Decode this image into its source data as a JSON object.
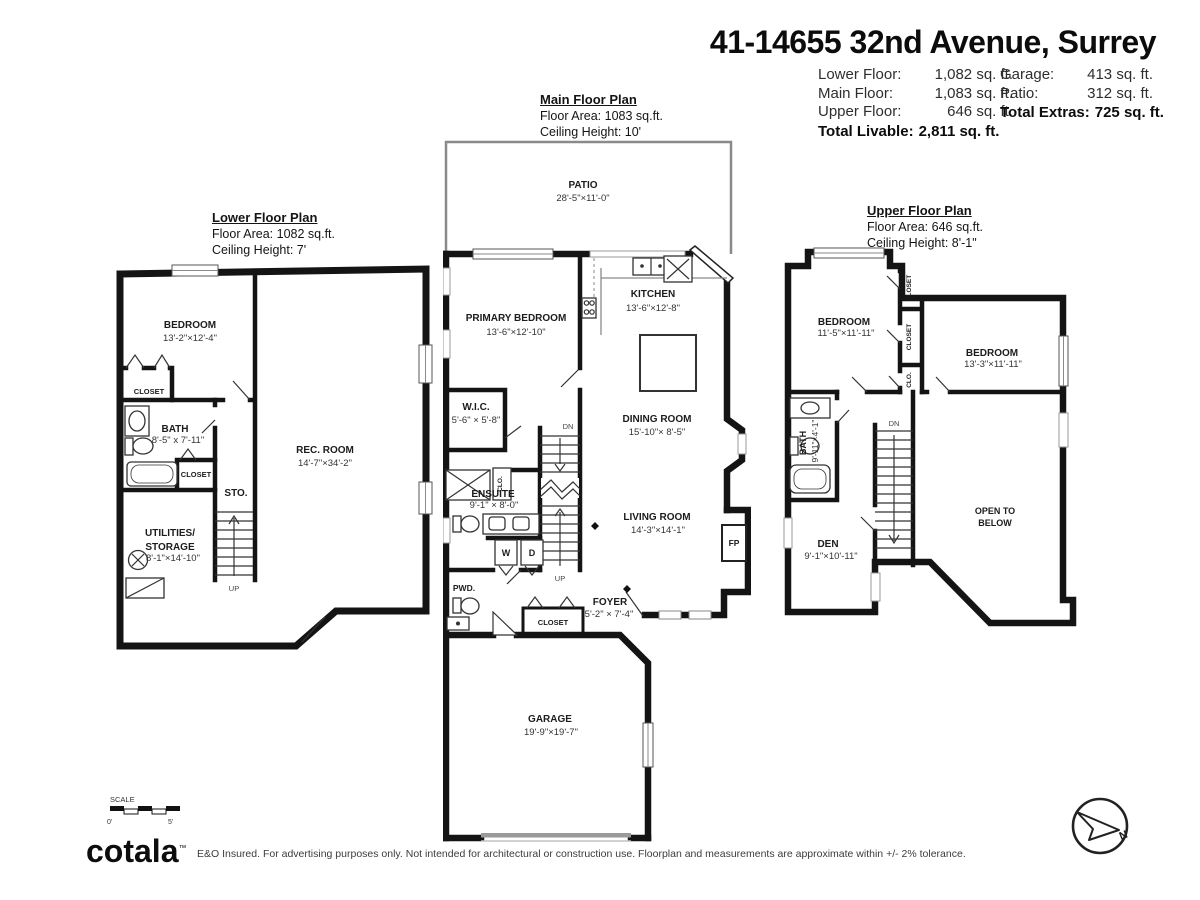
{
  "header": {
    "title": "41-14655 32nd Avenue, Surrey",
    "left_rows": [
      {
        "label": "Lower Floor:",
        "value": "1,082 sq. ft."
      },
      {
        "label": "Main Floor:",
        "value": "1,083 sq. ft."
      },
      {
        "label": "Upper Floor:",
        "value": "646 sq. ft."
      }
    ],
    "total_livable_label": "Total Livable:",
    "total_livable_value": "2,811 sq. ft.",
    "right_rows": [
      {
        "label": "Garage:",
        "value": "413 sq. ft."
      },
      {
        "label": "Patio:",
        "value": "312 sq. ft."
      }
    ],
    "total_extras_label": "Total Extras:",
    "total_extras_value": "725 sq. ft."
  },
  "lower": {
    "title": "Lower Floor Plan",
    "area": "Floor Area: 1082 sq.ft.",
    "ceiling": "Ceiling Height: 7'",
    "bedroom": "BEDROOM",
    "bedroom_dims": "13'-2\"×12'-4\"",
    "closet1": "CLOSET",
    "bath": "BATH",
    "bath_dims": "8'-5\" x 7'-11\"",
    "closet2": "CLOSET",
    "sto": "STO.",
    "rec": "REC. ROOM",
    "rec_dims": "14'-7\"×34'-2\"",
    "util1": "UTILITIES/",
    "util2": "STORAGE",
    "util_dims": "8'-1\"×14'-10\"",
    "up": "UP"
  },
  "main": {
    "title": "Main Floor Plan",
    "area": "Floor Area: 1083 sq.ft.",
    "ceiling": "Ceiling Height: 10'",
    "patio": "PATIO",
    "patio_dims": "28'-5\"×11'-0\"",
    "primary": "PRIMARY BEDROOM",
    "primary_dims": "13'-6\"×12'-10\"",
    "kitchen": "KITCHEN",
    "kitchen_dims": "13'-6\"×12'-8\"",
    "wic": "W.I.C.",
    "wic_dims": "5'-6\" × 5'-8\"",
    "dining": "DINING ROOM",
    "dining_dims": "15'-10\"× 8'-5\"",
    "living": "LIVING ROOM",
    "living_dims": "14'-3\"×14'-1\"",
    "ensuite": "ENSUITE",
    "ensuite_dims": "9'-1\" × 8'-0\"",
    "foyer": "FOYER",
    "foyer_dims": "5'-2\" × 7'-4\"",
    "garage": "GARAGE",
    "garage_dims": "19'-9\"×19'-7\"",
    "pwd": "PWD.",
    "closet": "CLOSET",
    "clo": "CLO.",
    "w": "W",
    "d": "D",
    "fp": "FP",
    "dn": "DN",
    "up": "UP"
  },
  "upper": {
    "title": "Upper Floor Plan",
    "area": "Floor Area: 646 sq.ft.",
    "ceiling": "Ceiling Height: 8'-1\"",
    "bedroom1": "BEDROOM",
    "bedroom1_dims": "11'-5\"×11'-11\"",
    "bedroom2": "BEDROOM",
    "bedroom2_dims": "13'-3\"×11'-11\"",
    "closet1": "CLOSET",
    "closet2": "CLOSET",
    "clo": "CLO.",
    "bath": "BATH",
    "bath_dims": "9'-11\"×4'-1\"",
    "den": "DEN",
    "den_dims": "9'-1\"×10'-11\"",
    "open1": "OPEN TO",
    "open2": "BELOW",
    "dn": "DN"
  },
  "footer": {
    "scale": "SCALE",
    "scale0": "0'",
    "scale5": "5'",
    "logo": "cotala",
    "tm": "™",
    "disclaimer": "E&O Insured. For advertising purposes only. Not intended for architectural or construction use. Floorplan and measurements are approximate within +/- 2% tolerance.",
    "north": "N"
  }
}
